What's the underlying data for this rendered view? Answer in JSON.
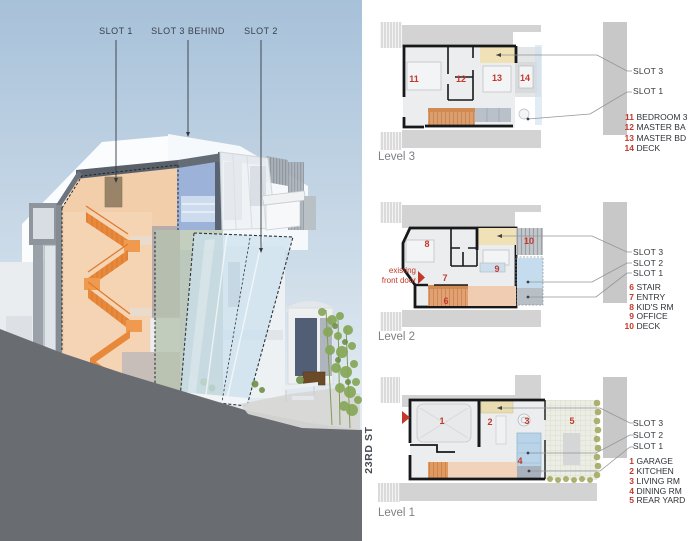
{
  "render": {
    "slot1_label": "SLOT 1",
    "slot3_label": "SLOT 3 BEHIND",
    "slot2_label": "SLOT 2"
  },
  "levels": [
    {
      "name": "Level 3",
      "slots": [
        "SLOT 3",
        "SLOT 1"
      ],
      "rooms": [
        "11",
        "12",
        "13",
        "14"
      ],
      "legend": [
        {
          "num": "11",
          "label": "BEDROOM 3"
        },
        {
          "num": "12",
          "label": "MASTER BA"
        },
        {
          "num": "13",
          "label": "MASTER BD"
        },
        {
          "num": "14",
          "label": "DECK"
        }
      ]
    },
    {
      "name": "Level 2",
      "slots": [
        "SLOT 3",
        "SLOT 2",
        "SLOT 1"
      ],
      "rooms": [
        "6",
        "7",
        "8",
        "9",
        "10"
      ],
      "legend": [
        {
          "num": "6",
          "label": "STAIR"
        },
        {
          "num": "7",
          "label": "ENTRY"
        },
        {
          "num": "8",
          "label": "KID'S RM"
        },
        {
          "num": "9",
          "label": "OFFICE"
        },
        {
          "num": "10",
          "label": "DECK"
        }
      ],
      "annotation": {
        "line1": "existing",
        "line2": "front door"
      }
    },
    {
      "name": "Level 1",
      "slots": [
        "SLOT 3",
        "SLOT 2",
        "SLOT 1"
      ],
      "rooms": [
        "1",
        "2",
        "3",
        "4",
        "5"
      ],
      "legend": [
        {
          "num": "1",
          "label": "GARAGE"
        },
        {
          "num": "2",
          "label": "KITCHEN"
        },
        {
          "num": "3",
          "label": "LIVING RM"
        },
        {
          "num": "4",
          "label": "DINING RM"
        },
        {
          "num": "5",
          "label": "REAR YARD"
        }
      ],
      "street": "23RD ST"
    }
  ],
  "colors": {
    "accent_red": "#c2392b",
    "slot_yellow": "#f0e2b6",
    "slot_blue": "#c4dced",
    "stair_orange": "#e2995f",
    "neighbor_gray": "#d3d3d3",
    "text_dark": "#33373c",
    "text_gray": "#7d8084"
  }
}
